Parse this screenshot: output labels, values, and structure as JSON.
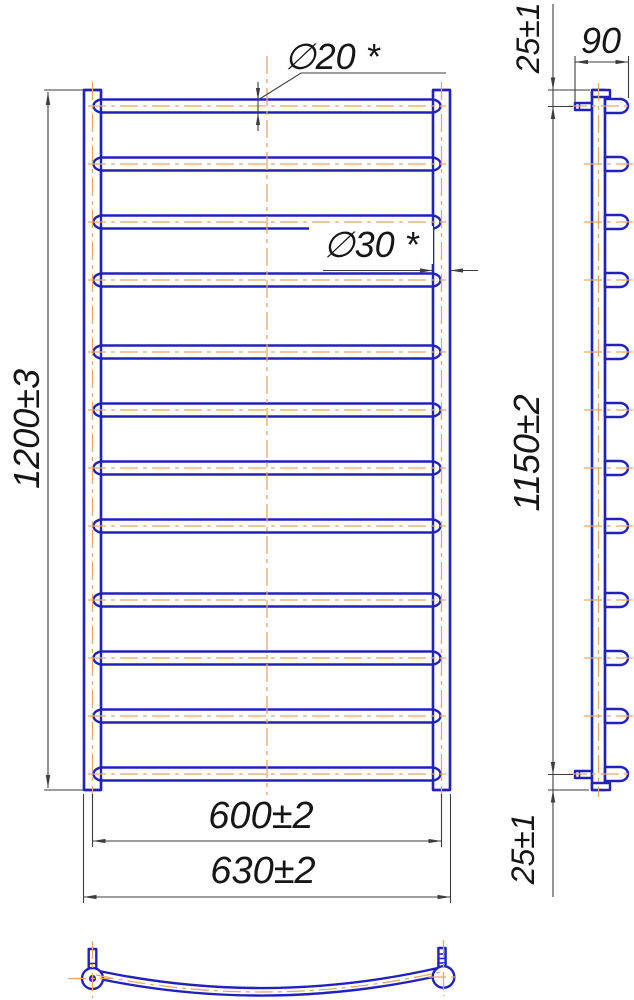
{
  "title": "heated towel rail dimensional drawing",
  "labels": {
    "dia20": "∅20 *",
    "dia30": "∅30 *",
    "height": "1200±3",
    "axis_width": "600±2",
    "overall_width": "630±2",
    "top_offset": "25±1",
    "depth": "90",
    "axis_height": "1150±2",
    "bottom_offset": "25±1"
  },
  "views": {
    "front": {
      "name": "front-view",
      "rung_count": 12
    },
    "side": {
      "name": "side-view",
      "rung_count": 12,
      "wall_brackets": 2
    },
    "bottom": {
      "name": "bottom-view",
      "curved_rung": true
    }
  },
  "colors": {
    "part_blue": "#2222bb",
    "centerline_orange": "#e2a96e",
    "dim_line": "#3d3d3d",
    "text": "#161616",
    "background": "#ffffff"
  }
}
